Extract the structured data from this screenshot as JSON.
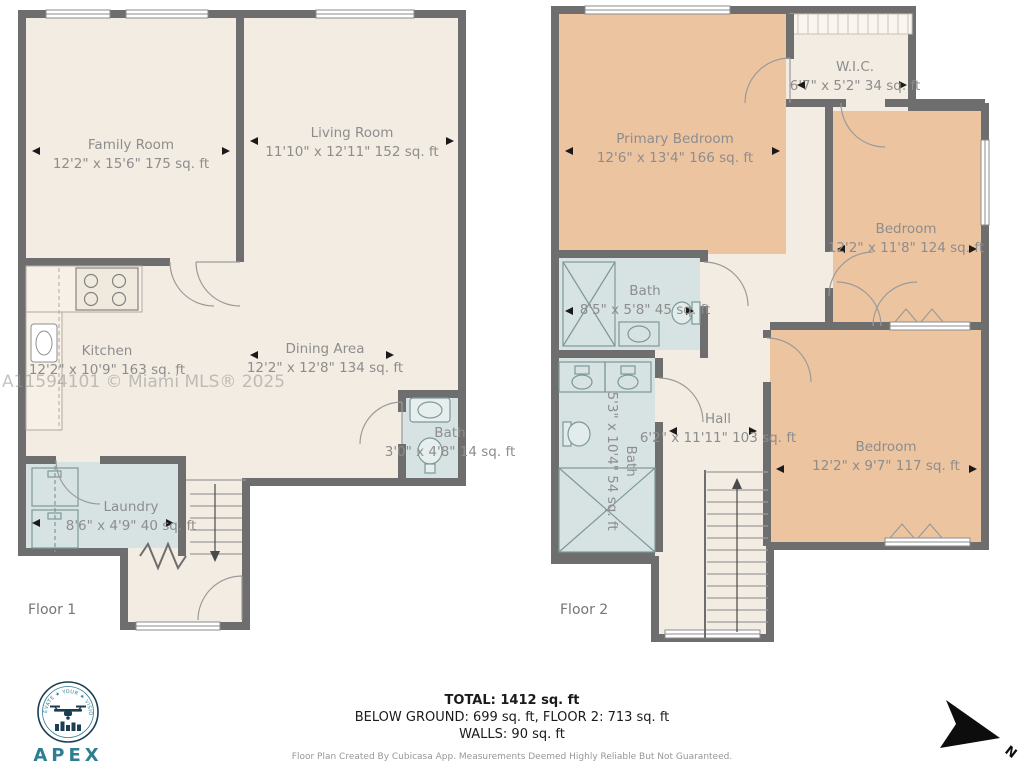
{
  "watermark": "A11594101 © Miami MLS® 2025",
  "floor1": {
    "label": "Floor 1",
    "rooms": {
      "family": {
        "name": "Family Room",
        "dims": "12'2\" x 15'6\" 175 sq. ft"
      },
      "living": {
        "name": "Living Room",
        "dims": "11'10\" x 12'11\" 152 sq. ft"
      },
      "kitchen": {
        "name": "Kitchen",
        "dims": "12'2\" x 10'9\" 163 sq. ft"
      },
      "dining": {
        "name": "Dining Area",
        "dims": "12'2\" x 12'8\" 134 sq. ft"
      },
      "bath": {
        "name": "Bath",
        "dims": "3'0\" x 4'8\" 14 sq. ft"
      },
      "laundry": {
        "name": "Laundry",
        "dims": "8'6\" x 4'9\" 40 sq. ft"
      }
    }
  },
  "floor2": {
    "label": "Floor 2",
    "rooms": {
      "primary": {
        "name": "Primary Bedroom",
        "dims": "12'6\" x 13'4\" 166 sq. ft"
      },
      "wic": {
        "name": "W.I.C.",
        "dims": "6'7\" x 5'2\" 34 sq. ft"
      },
      "bedroom_top": {
        "name": "Bedroom",
        "dims": "12'2\" x 11'8\" 124 sq. ft"
      },
      "bath_top": {
        "name": "Bath",
        "dims": "8'5\" x 5'8\" 45 sq. ft"
      },
      "bath_left": {
        "name": "Bath",
        "dims": "5'3\" x 10'4\" 54 sq. ft"
      },
      "hall": {
        "name": "Hall",
        "dims": "6'2\" x 11'11\" 103 sq. ft"
      },
      "bedroom_bottom": {
        "name": "Bedroom",
        "dims": "12'2\" x 9'7\" 117 sq. ft"
      }
    }
  },
  "footer": {
    "total": "TOTAL: 1412 sq. ft",
    "breakdown": "BELOW GROUND: 699 sq. ft, FLOOR 2: 713 sq. ft",
    "walls": "WALLS: 90 sq. ft",
    "disclaimer": "Floor Plan Created By Cubicasa App. Measurements Deemed Highly Reliable But Not Guaranteed."
  },
  "logo": {
    "tagline": "ELEVATE ★ YOUR ★ VISION",
    "brand": "APEX",
    "sub": "— AUDACITY —"
  },
  "compass": {
    "north": "N"
  },
  "colors": {
    "wall": "#6e6e6e",
    "room_beige": "#f3ece3",
    "room_wet": "#d7e3e2",
    "room_bedroom": "#edc4a0",
    "label_text": "#8d8d8d"
  }
}
